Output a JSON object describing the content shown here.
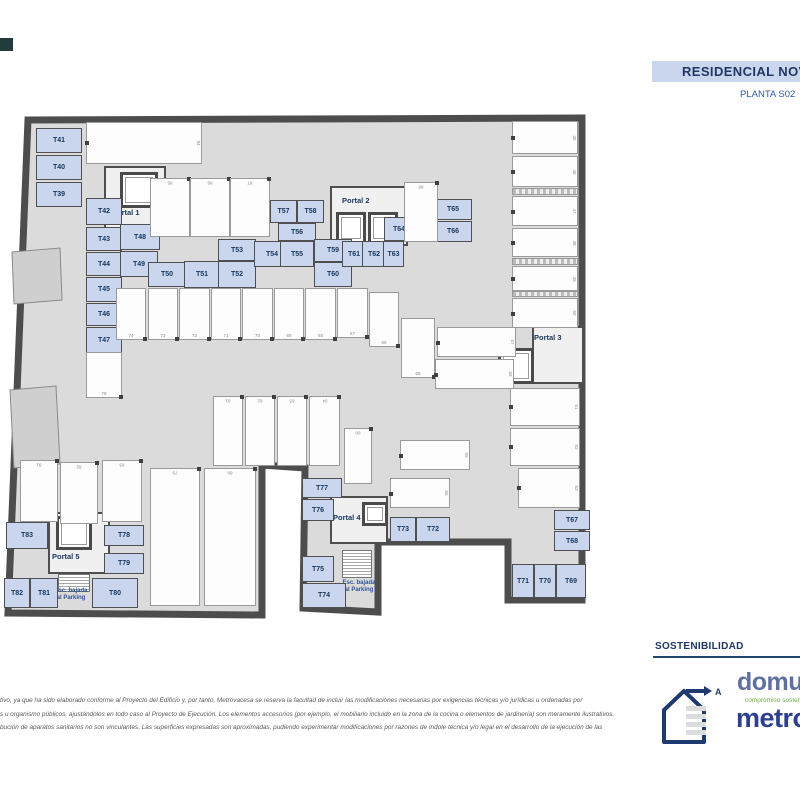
{
  "header": {
    "title": "RESIDENCIAL NOVA",
    "subtitle": "PLANTA S02"
  },
  "colors": {
    "accent_blue": "#c9d6ee",
    "navy": "#1f3864",
    "storage_fill": "#c9d6ee",
    "wall_gray": "#4d4d4d",
    "floor_gray": "#dbdbdb",
    "metrovacesa_blue": "#2d3f8f",
    "domum_green": "#70ad47"
  },
  "plan": {
    "portals": [
      {
        "label": "Portal 1"
      },
      {
        "label": "Portal 2"
      },
      {
        "label": "Portal 3"
      },
      {
        "label": "Portal 4"
      },
      {
        "label": "Portal 5"
      }
    ],
    "stairs": {
      "line1": "Esc. bajada",
      "line2": "al Parking"
    },
    "trasteros": [
      "T39",
      "T40",
      "T41",
      "T42",
      "T43",
      "T44",
      "T45",
      "T46",
      "T47",
      "T48",
      "T49",
      "T50",
      "T51",
      "T52",
      "T53",
      "T54",
      "T55",
      "T56",
      "T57",
      "T58",
      "T59",
      "T60",
      "T61",
      "T62",
      "T63",
      "T64",
      "T65",
      "T66",
      "T67",
      "T68",
      "T69",
      "T70",
      "T71",
      "T72",
      "T73",
      "T74",
      "T75",
      "T76",
      "T77",
      "T78",
      "T79",
      "T80",
      "T81",
      "T82",
      "T83"
    ],
    "parking_numbers": [
      "84",
      "85",
      "86",
      "87",
      "88",
      "45",
      "46",
      "47",
      "48",
      "49",
      "50",
      "51",
      "52",
      "53",
      "74",
      "73",
      "72",
      "71",
      "70",
      "69",
      "68",
      "67",
      "66",
      "65",
      "57",
      "56",
      "61",
      "62",
      "63",
      "64",
      "60",
      "59",
      "55",
      "78",
      "81",
      "82",
      "83",
      "79",
      "80"
    ]
  },
  "footer": {
    "disclaimer_lines": [
      "tivo, ya que ha sido elaborado conforme al Proyecto del Edificio y, por tanto, Metrovacesa se reserva la facultad de incluir las modificaciones necesarias por exigencias técnicas y/o jurídicas u ordenadas por",
      "s u organismo públicos, ajustándolos en todo caso al Proyecto de Ejecución. Los elementos accesorios (por ejemplo, el mobiliario incluido en la zona de la cocina o elementos de jardinería) son meramente ilustrativos.",
      "bución de aparatos sanitarios no son vinculantes. Las superficies expresadas son aproximadas, pudiendo experimentar modificaciones por razones de índole técnica y/o legal en el desarrollo de la ejecución de las"
    ],
    "sustainability_label": "SOSTENIBILIDAD",
    "logo_domum": "domum",
    "logo_domum_tagline": "compromiso sostenible",
    "logo_metrovacesa": "metrovacesa",
    "energy_label": "A"
  }
}
